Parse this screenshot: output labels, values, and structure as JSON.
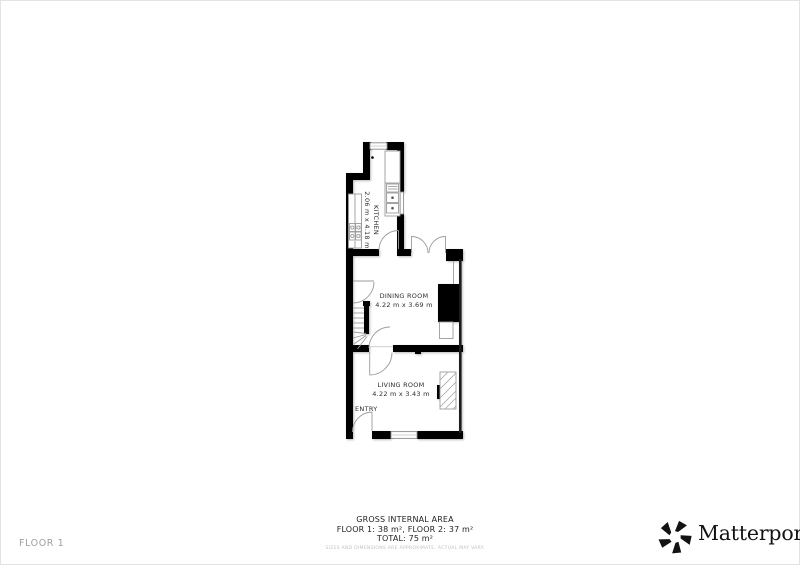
{
  "floorplan": {
    "rooms": [
      {
        "name": "KITCHEN",
        "dimensions": "2.06 m x 4.18 m"
      },
      {
        "name": "DINING ROOM",
        "dimensions": "4.22 m x 3.69 m"
      },
      {
        "name": "LIVING ROOM",
        "dimensions": "4.22 m x 3.43 m"
      }
    ],
    "entry_label": "ENTRY"
  },
  "footer": {
    "area_title": "GROSS INTERNAL AREA",
    "area_line": "FLOOR 1: 38 m², FLOOR 2: 37 m²",
    "total_line": "TOTAL: 75 m²",
    "disclaimer": "SIZES AND DIMENSIONS ARE APPROXIMATE, ACTUAL MAY VARY.",
    "floor_label": "FLOOR 1"
  },
  "branding": {
    "logo_text": "Matterport",
    "registered_mark": "®"
  },
  "colors": {
    "wall": "#000000",
    "thin_line": "#9b9b9b",
    "label_text": "#2d2d2d",
    "muted_text": "#c2c2c2",
    "floor_label_text": "#9e9e9e"
  }
}
